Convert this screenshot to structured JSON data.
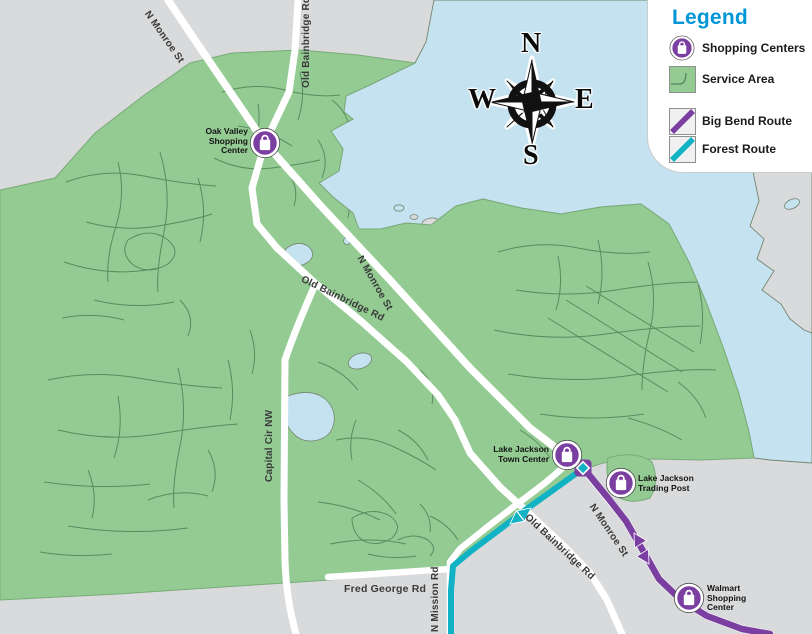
{
  "legend": {
    "title": "Legend",
    "items": [
      {
        "label": "Shopping Centers",
        "icon": "shopping-bag-icon"
      },
      {
        "label": "Service Area",
        "icon": "service-area-swatch"
      },
      {
        "label": "Big Bend Route",
        "icon": "route-line-swatch"
      },
      {
        "label": "Forest Route",
        "icon": "route-line-swatch"
      }
    ]
  },
  "compass": {
    "n": "N",
    "s": "S",
    "e": "E",
    "w": "W"
  },
  "colors": {
    "background": "#D9DADB",
    "service_area": "#93CB93",
    "lake": "#C5E2F0",
    "road": "#FFFFFF",
    "legend_title": "#0096D7"
  },
  "routes": {
    "big_bend": {
      "name": "Big Bend Route",
      "color": "#7B3FA2"
    },
    "forest": {
      "name": "Forest Route",
      "color": "#10B2C4"
    }
  },
  "map": {
    "road_labels": [
      {
        "text": "N Monroe St"
      },
      {
        "text": "Old Bainbridge Rd"
      },
      {
        "text": "Old Bainbridge Rd"
      },
      {
        "text": "N Monroe St"
      },
      {
        "text": "Capital Cir NW"
      },
      {
        "text": "Old Bainbridge Rd"
      },
      {
        "text": "N Monroe St"
      },
      {
        "text": "Fred George Rd"
      },
      {
        "text": "N Mission Rd"
      }
    ],
    "shopping_centers": [
      {
        "name": "Oak Valley\nShopping\nCenter"
      },
      {
        "name": "Lake Jackson\nTown Center"
      },
      {
        "name": "Lake Jackson\nTrading Post"
      },
      {
        "name": "Walmart\nShopping\nCenter"
      }
    ]
  }
}
